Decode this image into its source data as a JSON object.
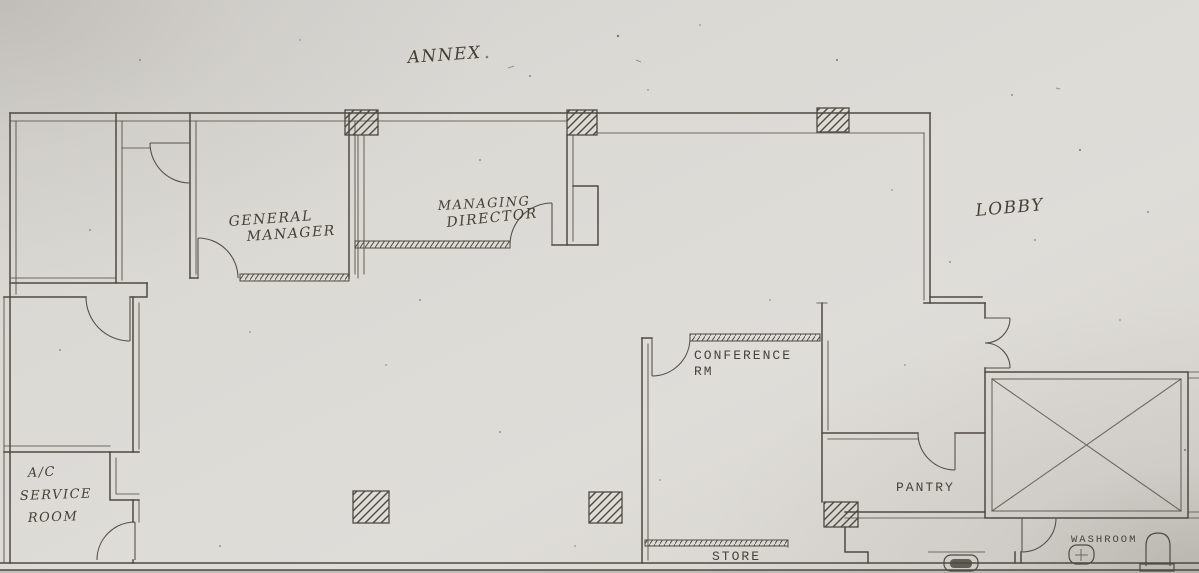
{
  "plan": {
    "labels": {
      "annex": "ANNEX",
      "lobby": "LOBBY",
      "general_manager": {
        "line1": "GENERAL",
        "line2": "MANAGER"
      },
      "managing_director": {
        "line1": "MANAGING",
        "line2": "DIRECTOR"
      },
      "conference": {
        "line1": "CONFERENCE",
        "line2": "RM"
      },
      "pantry": "PANTRY",
      "store": "STORE",
      "washroom": "WASHROOM",
      "ac_service": {
        "line1": "A/C",
        "line2": "SERVICE",
        "line3": "ROOM"
      }
    },
    "symbols": {
      "columns": "hatched-column",
      "shaft": "crossed-shaft-box",
      "toilet": "toilet-symbol",
      "sink": "pedestal-sink-symbol",
      "water_closet": "wc-basin-symbol"
    },
    "colors": {
      "paper": "#dbd9d4",
      "ink": "#4e4a42",
      "pencil": "#453f35"
    }
  }
}
